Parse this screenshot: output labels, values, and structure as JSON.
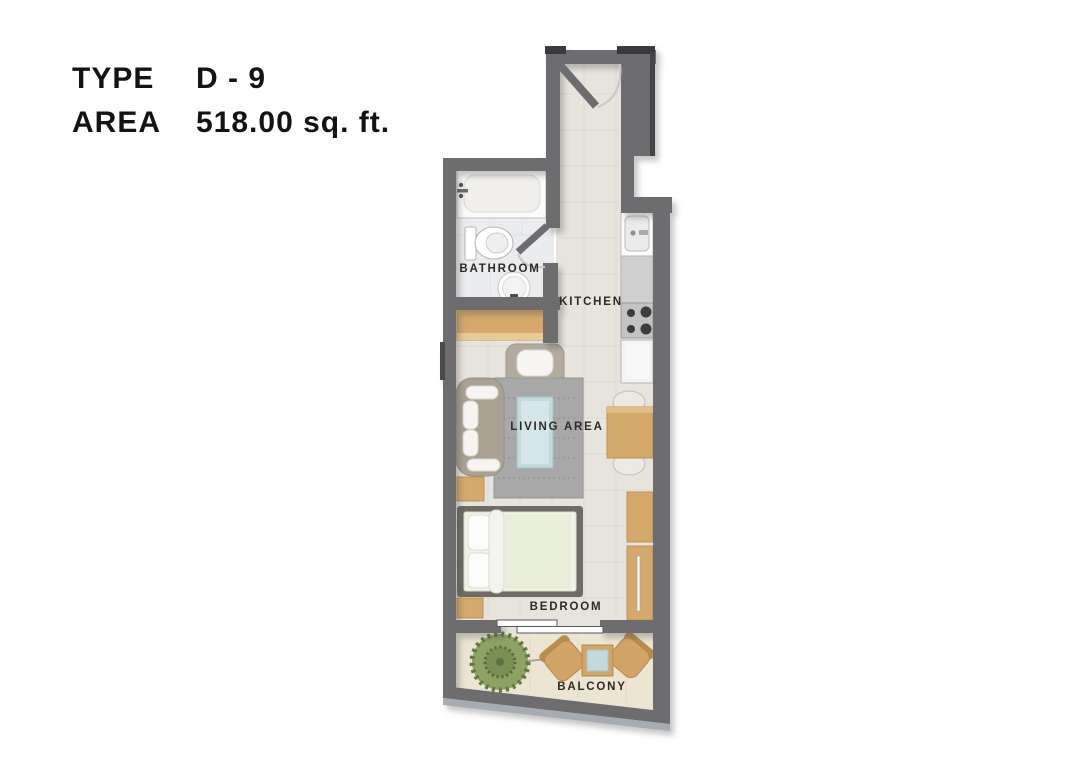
{
  "header": {
    "type_label": "TYPE",
    "type_value": "D - 9",
    "area_label": "AREA",
    "area_value": "518.00 sq. ft."
  },
  "floorplan": {
    "rooms": {
      "bathroom": "BATHROOM",
      "kitchen": "KITCHEN",
      "living": "LIVING AREA",
      "bedroom": "BEDROOM",
      "balcony": "BALCONY"
    }
  },
  "colors": {
    "wall": "#6d6d6f",
    "wall_cap": "#3a3a3c",
    "floor": "#e7e4de",
    "bathroom_floor": "#eaeced",
    "balcony_floor": "#ece5d2",
    "furniture_tan": "#d4a96b",
    "table_top_blue": "#c3dadc",
    "plant_green": "#8da263",
    "rug_gray": "#a8a8a8",
    "label_text": "#2e2b27",
    "header_text": "#131313"
  }
}
